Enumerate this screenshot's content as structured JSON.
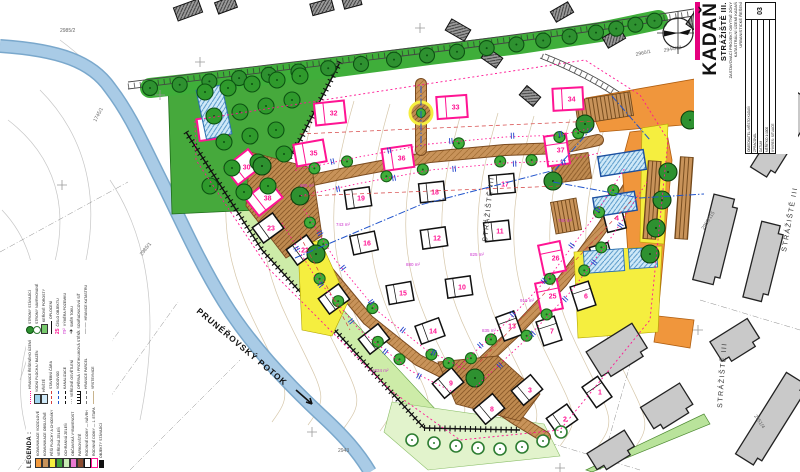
{
  "labels": {
    "stream": "PRUNÉŘOVSKÝ POTOK",
    "district": "STRÁŽIŠTĚ III",
    "legend_title": "LEGENDA :"
  },
  "title_block": {
    "city": "KADAŇ",
    "site": "STRÁŽIŠTĚ III.",
    "accent": "#e6007e",
    "sub_lines": [
      "ZASTAVOVACÍ PROJEKT OBYTNÉ ZÓNY",
      "KATASTRÁLNÍ ÚZEMÍ KADAŇ",
      "URBANISTICKÉ ŘEŠENÍ"
    ],
    "table_rows": [
      "OBJEDNATEL: MĚSTO KADAŇ",
      "ZPRACOVAL",
      "DATUM",
      "MĚŘÍTKO 1:1000",
      "VÝKRES: SITUACE"
    ],
    "sheet_no": "03"
  },
  "district_labels": [
    {
      "x": 487,
      "y": 242,
      "r": -84
    },
    {
      "x": 786,
      "y": 252,
      "r": -80
    },
    {
      "x": 722,
      "y": 408,
      "r": -86
    }
  ],
  "parcel_labels": [
    {
      "t": "2985/2",
      "x": 60,
      "y": 32,
      "r": 0
    },
    {
      "t": "1745/1",
      "x": 96,
      "y": 122,
      "r": -62
    },
    {
      "t": "2985/1",
      "x": 142,
      "y": 256,
      "r": -52
    },
    {
      "t": "2944/12",
      "x": 664,
      "y": 52,
      "r": -10
    },
    {
      "t": "2953/119",
      "x": 768,
      "y": 142,
      "r": -58
    },
    {
      "t": "2953/115",
      "x": 704,
      "y": 230,
      "r": -58
    },
    {
      "t": "2951/4",
      "x": 754,
      "y": 416,
      "r": 56
    },
    {
      "t": "2960/1",
      "x": 636,
      "y": 56,
      "r": -12
    },
    {
      "t": "2943",
      "x": 338,
      "y": 452,
      "r": 0
    }
  ],
  "area_labels": [
    {
      "t": "695 m²",
      "x": 300,
      "y": 187
    },
    {
      "t": "743 m²",
      "x": 336,
      "y": 226
    },
    {
      "t": "880 m²",
      "x": 406,
      "y": 266
    },
    {
      "t": "825 m²",
      "x": 470,
      "y": 256
    },
    {
      "t": "760 m²",
      "x": 558,
      "y": 222
    },
    {
      "t": "910 m²",
      "x": 520,
      "y": 302
    },
    {
      "t": "835 m²",
      "x": 482,
      "y": 332
    },
    {
      "t": "1024 m²",
      "x": 372,
      "y": 372
    }
  ],
  "houses": {
    "pink": [
      {
        "n": "31",
        "x": 213,
        "y": 128,
        "r": -8
      },
      {
        "n": "32",
        "x": 330,
        "y": 113,
        "r": -6
      },
      {
        "n": "33",
        "x": 452,
        "y": 107,
        "r": -4
      },
      {
        "n": "34",
        "x": 568,
        "y": 99,
        "r": -3
      },
      {
        "n": "35",
        "x": 310,
        "y": 153,
        "r": -10
      },
      {
        "n": "36",
        "x": 398,
        "y": 158,
        "r": -8
      },
      {
        "n": "30",
        "x": 243,
        "y": 167,
        "r": -38
      },
      {
        "n": "38",
        "x": 264,
        "y": 198,
        "r": -38
      },
      {
        "n": "37",
        "x": 557,
        "y": 150,
        "r": 82
      },
      {
        "n": "26",
        "x": 552,
        "y": 258,
        "r": 78
      },
      {
        "n": "25",
        "x": 549,
        "y": 296,
        "r": 78
      }
    ],
    "black": [
      {
        "n": "19",
        "x": 358,
        "y": 198,
        "r": -8
      },
      {
        "n": "18",
        "x": 432,
        "y": 192,
        "r": -6
      },
      {
        "n": "17",
        "x": 502,
        "y": 184,
        "r": -5
      },
      {
        "n": "23",
        "x": 268,
        "y": 228,
        "r": -36
      },
      {
        "n": "22",
        "x": 302,
        "y": 250,
        "r": -36
      },
      {
        "n": "16",
        "x": 364,
        "y": 243,
        "r": -12
      },
      {
        "n": "12",
        "x": 434,
        "y": 238,
        "r": -8
      },
      {
        "n": "11",
        "x": 497,
        "y": 231,
        "r": -6
      },
      {
        "n": "21",
        "x": 334,
        "y": 299,
        "r": -36
      },
      {
        "n": "15",
        "x": 400,
        "y": 293,
        "r": -10
      },
      {
        "n": "10",
        "x": 459,
        "y": 287,
        "r": -8
      },
      {
        "n": "20",
        "x": 374,
        "y": 339,
        "r": -38
      },
      {
        "n": "14",
        "x": 430,
        "y": 331,
        "r": -20
      },
      {
        "n": "13",
        "x": 509,
        "y": 326,
        "r": 70
      },
      {
        "n": "9",
        "x": 448,
        "y": 383,
        "r": -40
      },
      {
        "n": "8",
        "x": 489,
        "y": 409,
        "r": -40
      },
      {
        "n": "7",
        "x": 549,
        "y": 331,
        "r": 72
      },
      {
        "n": "6",
        "x": 583,
        "y": 296,
        "r": 72
      },
      {
        "n": "5",
        "x": 602,
        "y": 257,
        "r": 74
      },
      {
        "n": "4",
        "x": 614,
        "y": 218,
        "r": 76
      },
      {
        "n": "3",
        "x": 527,
        "y": 390,
        "r": -40
      },
      {
        "n": "2",
        "x": 562,
        "y": 419,
        "r": -35
      },
      {
        "n": "1",
        "x": 597,
        "y": 392,
        "r": 55
      }
    ]
  },
  "map": {
    "streets": {
      "A": [
        [
          298,
          183
        ],
        [
          360,
          170
        ],
        [
          430,
          157
        ],
        [
          505,
          150
        ],
        [
          562,
          148
        ],
        [
          598,
          140
        ]
      ],
      "B": [
        [
          293,
          216
        ],
        [
          325,
          268
        ],
        [
          368,
          320
        ],
        [
          418,
          360
        ],
        [
          460,
          381
        ]
      ],
      "C": [
        [
          467,
          377
        ],
        [
          515,
          332
        ],
        [
          562,
          282
        ],
        [
          602,
          228
        ],
        [
          636,
          175
        ]
      ],
      "CONN": [
        [
          421,
          84
        ],
        [
          421,
          150
        ]
      ],
      "EXIT": [
        [
          472,
          390
        ],
        [
          517,
          420
        ],
        [
          545,
          437
        ]
      ]
    },
    "park_trees": [
      [
        205,
        92
      ],
      [
        228,
        88
      ],
      [
        252,
        84
      ],
      [
        277,
        80
      ],
      [
        300,
        76
      ],
      [
        214,
        116
      ],
      [
        240,
        112
      ],
      [
        266,
        106
      ],
      [
        292,
        100
      ],
      [
        224,
        142
      ],
      [
        250,
        136
      ],
      [
        276,
        130
      ],
      [
        232,
        168
      ],
      [
        258,
        162
      ],
      [
        284,
        154
      ],
      [
        244,
        192
      ],
      [
        268,
        186
      ],
      [
        210,
        186
      ]
    ],
    "big_trees": [
      [
        262,
        166
      ],
      [
        300,
        196
      ],
      [
        316,
        254
      ],
      [
        585,
        124
      ],
      [
        553,
        181
      ],
      [
        475,
        378
      ],
      [
        668,
        172
      ],
      [
        662,
        200
      ],
      [
        656,
        228
      ],
      [
        650,
        254
      ],
      [
        690,
        120
      ]
    ],
    "bottom_trees": [
      [
        412,
        440
      ],
      [
        434,
        443
      ],
      [
        456,
        446
      ],
      [
        478,
        448
      ],
      [
        500,
        449
      ],
      [
        522,
        447
      ],
      [
        543,
        441
      ],
      [
        561,
        432
      ]
    ],
    "pool": {
      "x": 214,
      "y": 112,
      "w": 26,
      "h": 50,
      "r": -12
    },
    "apartments": [
      {
        "x": 622,
        "y": 163,
        "w": 46,
        "h": 20,
        "r": -9
      },
      {
        "x": 615,
        "y": 204,
        "w": 42,
        "h": 19,
        "r": -9
      }
    ],
    "courts": [
      {
        "x": 604,
        "y": 261,
        "w": 40,
        "h": 22,
        "r": -4
      },
      {
        "x": 643,
        "y": 258,
        "w": 28,
        "h": 20,
        "r": -4
      }
    ],
    "parking": [
      {
        "x": 566,
        "y": 216,
        "w": 26,
        "h": 32,
        "r": -10
      },
      {
        "x": 604,
        "y": 108,
        "w": 56,
        "h": 24,
        "r": -9
      },
      {
        "x": 652,
        "y": 200,
        "w": 13,
        "h": 78,
        "r": 4
      },
      {
        "x": 684,
        "y": 198,
        "w": 13,
        "h": 82,
        "r": 4
      }
    ],
    "gray_buildings": [
      {
        "x": 742,
        "y": 100,
        "w": 96,
        "h": 26,
        "r": -58
      },
      {
        "x": 784,
        "y": 136,
        "w": 88,
        "h": 24,
        "r": -58
      },
      {
        "x": 716,
        "y": 240,
        "w": 88,
        "h": 26,
        "r": -76
      },
      {
        "x": 764,
        "y": 262,
        "w": 78,
        "h": 24,
        "r": -76
      },
      {
        "x": 618,
        "y": 352,
        "w": 54,
        "h": 34,
        "r": -32
      },
      {
        "x": 668,
        "y": 408,
        "w": 46,
        "h": 30,
        "r": -32
      },
      {
        "x": 736,
        "y": 342,
        "w": 44,
        "h": 28,
        "r": -32
      },
      {
        "x": 772,
        "y": 420,
        "w": 96,
        "h": 26,
        "r": -58
      },
      {
        "x": 612,
        "y": 452,
        "w": 44,
        "h": 24,
        "r": -32
      }
    ],
    "small_buildings": [
      {
        "x": 188,
        "y": 10,
        "w": 26,
        "h": 14,
        "r": -20
      },
      {
        "x": 226,
        "y": 5,
        "w": 20,
        "h": 12,
        "r": -20
      },
      {
        "x": 322,
        "y": 7,
        "w": 22,
        "h": 12,
        "r": -15
      },
      {
        "x": 352,
        "y": 2,
        "w": 18,
        "h": 10,
        "r": -15
      },
      {
        "x": 458,
        "y": 30,
        "w": 22,
        "h": 13,
        "r": 30
      },
      {
        "x": 492,
        "y": 58,
        "w": 18,
        "h": 12,
        "r": 35
      },
      {
        "x": 530,
        "y": 96,
        "w": 18,
        "h": 12,
        "r": 40
      },
      {
        "x": 562,
        "y": 12,
        "w": 20,
        "h": 12,
        "r": -30
      },
      {
        "x": 614,
        "y": 38,
        "w": 20,
        "h": 12,
        "r": -30
      },
      {
        "x": 700,
        "y": 18,
        "w": 26,
        "h": 16,
        "r": -55
      }
    ],
    "crosses": [
      [
        62,
        185
      ],
      [
        62,
        325
      ],
      [
        160,
        95
      ],
      [
        312,
        432
      ],
      [
        200,
        62
      ],
      [
        420,
        28
      ],
      [
        698,
        330
      ],
      [
        560,
        468
      ]
    ]
  },
  "legend": {
    "col1": [
      {
        "sw": "fill",
        "c": "#f29a3d",
        "label": "KOMUNIKACE VOZIDLOVÉ"
      },
      {
        "sw": "fill",
        "c": "#c8935a",
        "label": "KOMUNIKACE OBSLUŽNÉ"
      },
      {
        "sw": "fill",
        "c": "#f5ee3f",
        "label": "PĚŠÍ PLOCHY A CHODNÍKY"
      },
      {
        "sw": "fill",
        "c": "#3fa13a",
        "label": "VEŘEJNÁ ZELEŇ"
      },
      {
        "sw": "fill",
        "c": "#c9ecb4",
        "label": "OCHRANNÁ ZELEŇ"
      },
      {
        "sw": "fill",
        "c": "#e87ad0",
        "label": "OBČANSKÁ VYBAVENOST"
      },
      {
        "sw": "fill",
        "c": "#8a4b2f",
        "label": "PARKOVIŠTĚ"
      },
      {
        "sw": "stroke",
        "c": "#111111",
        "label": "RODINNÉ DOMY — NÁVRH"
      },
      {
        "sw": "stroke",
        "c": "#ff1493",
        "label": "RODINNÉ DOMY — 1. ETAPA"
      },
      {
        "sw": "fillb",
        "c": "#111111",
        "label": "OBJEKTY STÁVAJÍCÍ"
      }
    ],
    "col2": [
      {
        "sw": "dots",
        "c": "#ff1493",
        "label": "HRANICE ŘEŠENÉHO ÚZEMÍ"
      },
      {
        "sw": "fill",
        "c": "#9fd4ef",
        "label": "VODNÍ PLOCHA / BAZÉN"
      },
      {
        "sw": "fill",
        "c": "#cfe9f8",
        "label": "HŘIŠTĚ"
      },
      {
        "sw": "dash",
        "c": "#d43f3f",
        "label": "STAVEBNÍ ČÁRA"
      },
      {
        "sw": "dash",
        "c": "#2255cc",
        "label": "VODOVOD"
      },
      {
        "sw": "dash",
        "c": "#111111",
        "label": "KANALIZACE"
      },
      {
        "sw": "dot",
        "c": "#111111",
        "label": "VEŘEJNÉ OSVĚTLENÍ"
      },
      {
        "sw": "ticks",
        "c": "#111111",
        "label": "OPĚRNÁ / PROTIHLUKOVÁ STĚNA"
      },
      {
        "sw": "dash",
        "c": "#777777",
        "label": "HRANICE PARCEL"
      },
      {
        "sw": "line",
        "c": "#c8b48e",
        "label": "VRSTEVNICE"
      }
    ],
    "col3": [
      {
        "sw": "tree",
        "c": "#2e9130",
        "label": "STROMY STÁVAJÍCÍ"
      },
      {
        "sw": "treering",
        "c": "#2e7d32",
        "label": "STROMY NAVRHOVANÉ"
      },
      {
        "sw": "fill",
        "c": "#77c96d",
        "label": "KEŘOVÉ POROSTY"
      },
      {
        "sw": "line",
        "c": "#111111",
        "label": "OPLOCENÍ"
      },
      {
        "sw": "num",
        "c": "#ff1493",
        "label": "ČÍSLO OBJEKTU"
      },
      {
        "sw": "num2",
        "c": "#cc33cc",
        "label": "VÝMĚRA POZEMKU"
      },
      {
        "sw": "arrow",
        "c": "#111111",
        "label": "SMĚR TOKU"
      },
      {
        "sw": "cross",
        "c": "#888888",
        "label": "SOUŘADNICOVÁ SÍŤ"
      },
      {
        "sw": "dashdot",
        "c": "#555555",
        "label": "HRANICE KATASTRU"
      }
    ]
  },
  "colors": {
    "accent": "#e6007e",
    "pink": "#ff1493",
    "street": "#c8935a",
    "orange": "#f0963c",
    "yellow": "#f5ee3f",
    "park": "#46a93c",
    "tree": "#2e9130",
    "river": "#a9cbe6",
    "contour": "#c8b48e",
    "gray_building": "#c9c9c9"
  }
}
